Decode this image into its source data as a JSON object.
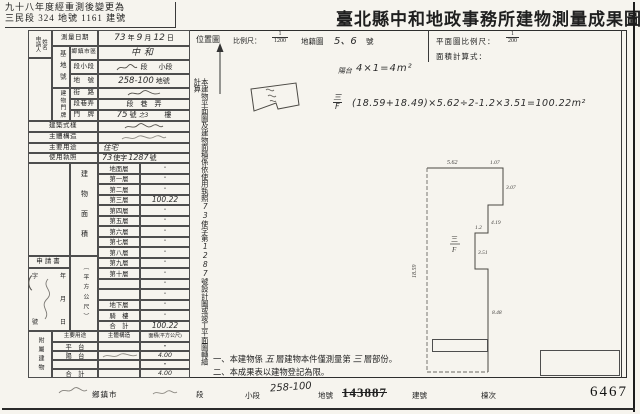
{
  "header": {
    "note_line1": "九十八年度經重測後變更為",
    "note_line2": "三民段 324 地號 1161 建號",
    "title": "臺北縣中和地政事務所建物測量成果圖"
  },
  "form": {
    "applicant_label_a": "申請人",
    "applicant_label_b": "姓名",
    "survey": {
      "label": "測量日期",
      "yy": "73",
      "y": "年",
      "mm": "9",
      "m": "月",
      "dd": "12",
      "d": "日"
    },
    "site_side": "基地號",
    "township": {
      "label": "鄉鎮市區",
      "value": "中和"
    },
    "section": {
      "label": "段小段",
      "print_a": "段",
      "print_b": "小段"
    },
    "lot": {
      "label": "地　號",
      "value": "258-100",
      "suffix": "地號"
    },
    "doorplate_side": "建物門牌",
    "street": {
      "label": "街　路"
    },
    "lane": {
      "label": "段巷弄",
      "print": "段　巷　弄"
    },
    "door": {
      "label": "門　牌",
      "hw_no": "75",
      "print_no": "號",
      "hw_sub": "之3",
      "print_floor": "樓"
    },
    "style_label": "建築式樣",
    "structure_label": "主體構造",
    "use": {
      "label": "主要用途",
      "value": "住宅"
    },
    "license": {
      "label": "使用執照",
      "hw_a": "73",
      "print_a": "使字",
      "hw_b": "1287",
      "print_b": "號"
    },
    "area_side": "建物面積",
    "area_unit": "（平方公尺）",
    "floors": [
      {
        "label": "地面層",
        "value": "•",
        "cls": "fval dot"
      },
      {
        "label": "第一層",
        "value": "•",
        "cls": "fval dot"
      },
      {
        "label": "第二層",
        "value": "•",
        "cls": "fval dot"
      },
      {
        "label": "第三層",
        "value": "100.22",
        "cls": "fval hwv"
      },
      {
        "label": "第四層",
        "value": "•",
        "cls": "fval dot"
      },
      {
        "label": "第五層",
        "value": "•",
        "cls": "fval dot"
      },
      {
        "label": "第六層",
        "value": "•",
        "cls": "fval dot"
      },
      {
        "label": "第七層",
        "value": "•",
        "cls": "fval dot"
      },
      {
        "label": "第八層",
        "value": "•",
        "cls": "fval dot"
      },
      {
        "label": "第九層",
        "value": "•",
        "cls": "fval dot"
      },
      {
        "label": "第十層",
        "value": "•",
        "cls": "fval dot"
      },
      {
        "label": "",
        "value": "•",
        "cls": "fval dot"
      },
      {
        "label": "",
        "value": "•",
        "cls": "fval dot"
      },
      {
        "label": "地下層",
        "value": "•",
        "cls": "fval dot"
      },
      {
        "label": "騎　樓",
        "value": "•",
        "cls": "fval dot"
      },
      {
        "label": "合　計",
        "value": "100.22",
        "cls": "fval hwv"
      }
    ],
    "application": {
      "label": "申請書",
      "r1l": "字",
      "r1r": "年",
      "r2r": "月",
      "r3l": "號",
      "r3r": "日"
    },
    "annex_side": "附屬建物",
    "annex_headers": [
      "主要用途",
      "主體構造",
      "面積(平方公尺)"
    ],
    "annex_rows": [
      {
        "use": "平　台",
        "area": "•",
        "cls": "acell dot"
      },
      {
        "use": "陽　台",
        "area": "4.00",
        "cls": "acell hwv"
      },
      {
        "use": "",
        "area": "•",
        "cls": "acell dot"
      },
      {
        "use": "合　計",
        "area": "4.00",
        "cls": "acell hwv"
      }
    ]
  },
  "right": {
    "loc_label": "位置圖",
    "scale_label": "比例尺：",
    "scale_num": "1",
    "scale_den": "1200",
    "cad_label": "地籍圖",
    "cad_hw": "5、6",
    "cad_suffix": "號",
    "plan_scale_label": "平面圖比例尺：",
    "plan_scale_num": "1",
    "plan_scale_den": "200",
    "calc_label": "面積計算式：",
    "vnote": {
      "p1": "本建物平面圖及建物面積係依使用執照",
      "hw1": "73",
      "p2": "使字第",
      "hw2": "1287",
      "p3": "號設計圖或竣工平面圖轉繪計算"
    },
    "calc1_prefix": "陽台",
    "calc1": "4×1=4m²",
    "calc2_top": "三",
    "calc2_bot": "F",
    "calc2": "(18.59+18.49)×5.62÷2-1.2×3.51=100.22m²",
    "plan": {
      "floor_top": "三",
      "floor_bot": "F",
      "dims": {
        "left": "18.59",
        "top": "5.62",
        "prot_top": "1.07",
        "prot_right": "3.07",
        "right_upper": "4.19",
        "notch_top": "1.2",
        "notch_side": "3.51",
        "right_lower": "8.48"
      }
    },
    "notes": {
      "n1a": "一、本建物係",
      "n1hw1": "五",
      "n1b": "層建物本件僅測量第",
      "n1hw2": "三",
      "n1c": "層部份。",
      "n2": "二、本成果表以建物登記為限。"
    }
  },
  "footer": {
    "township": "鄉鎮市",
    "section": "段",
    "subsection": "小段",
    "lot_hw": "258-100",
    "lot_label": "地號",
    "old_bldg_no": "143887",
    "bldg_label": "建號",
    "unit_label": "棟次",
    "serial": "6467"
  }
}
